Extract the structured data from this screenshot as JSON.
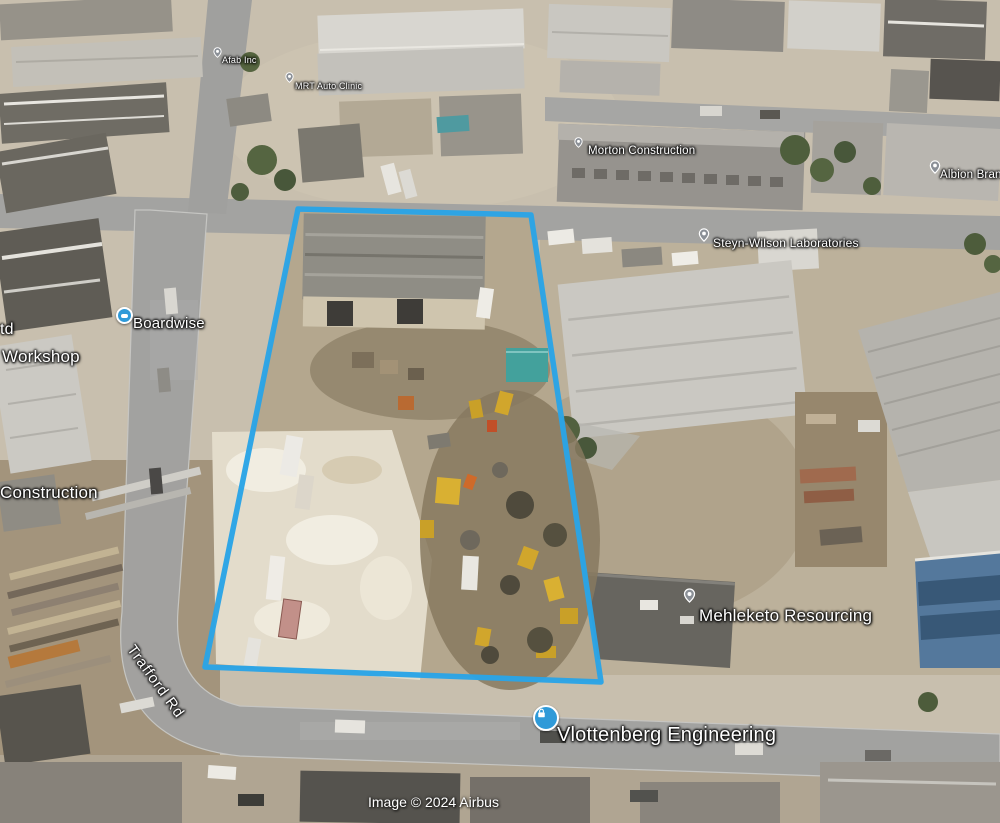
{
  "map": {
    "attribution": "Image © 2024 Airbus",
    "road_label": "Trafford Rd",
    "boundary_color": "#2aa4e6",
    "pin_color": "#8b9097",
    "business_icon_color": "#2f9ad8",
    "labels": {
      "ltd_clipped": "td",
      "workshop": "Workshop",
      "construction": "Construction",
      "boardwise": "Boardwise",
      "afab": "Afab Inc",
      "mrt_auto": "MRT Auto Clinic",
      "morton": "Morton Construction",
      "steyn_wilson": "Steyn-Wilson Laboratories",
      "albion": "Albion Brands",
      "mehleketo": "Mehleketo Resourcing",
      "vlottenberg": "Vlottenberg Engineering"
    },
    "icons": {
      "place_pin": "map-pin",
      "boardwise": "blue-business-dot",
      "vlottenberg": "blue-lock-badge"
    }
  }
}
